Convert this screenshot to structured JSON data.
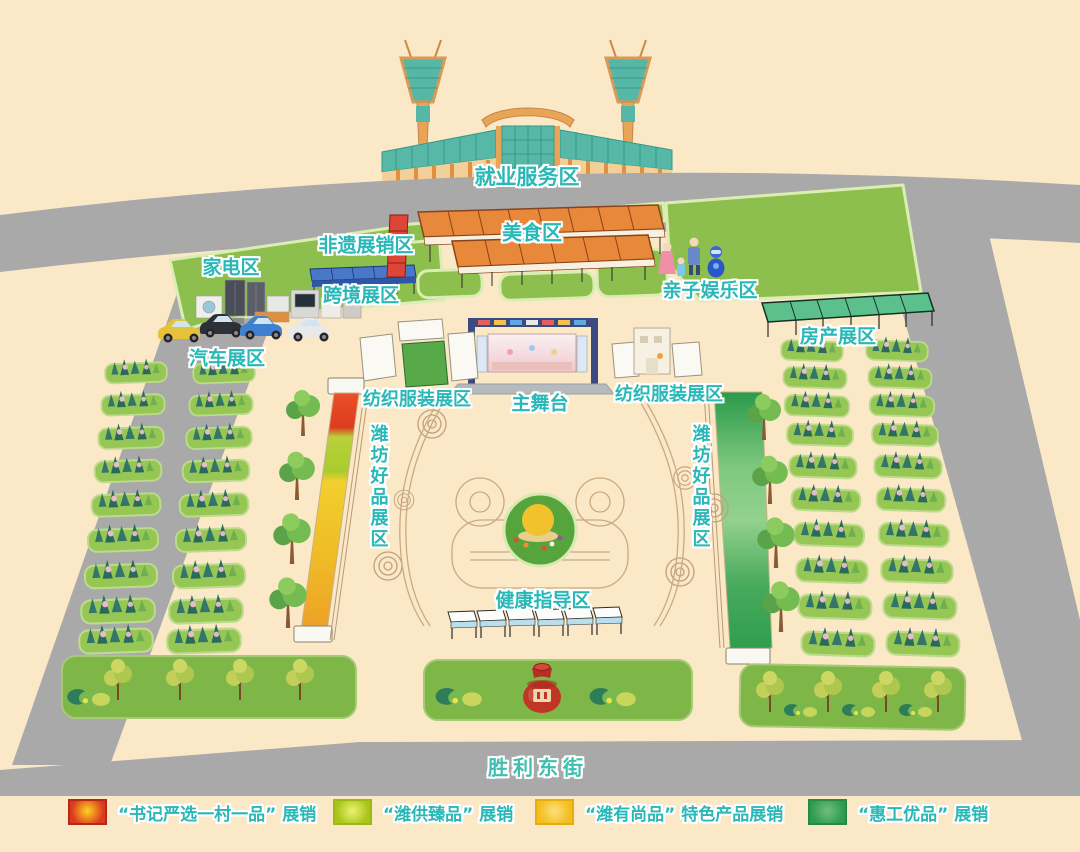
{
  "map": {
    "street": "胜利东街",
    "areas": {
      "employment": "就业服务区",
      "feiyi": "非遗展销区",
      "food": "美食区",
      "appliance": "家电区",
      "crossborder": "跨境展区",
      "family": "亲子娱乐区",
      "auto": "汽车展区",
      "realestate": "房产展区",
      "textile_left": "纺织服装展区",
      "main_stage": "主舞台",
      "textile_right": "纺织服装展区",
      "weifang_left": "潍坊好品展区",
      "weifang_right": "潍坊好品展区",
      "health": "健康指导区"
    }
  },
  "legend": {
    "items": [
      {
        "label": "“书记严选一村一品” 展销",
        "color": "#d93a20",
        "color_center": "#ffd320",
        "border": "#b22a14"
      },
      {
        "label": "“潍供臻品” 展销",
        "color": "#a7c51b",
        "color_center": "#eef26e",
        "border": "#9cb816"
      },
      {
        "label": "“潍有尚品” 特色产品展销",
        "color": "#f3bd1e",
        "color_center": "#fbe17c",
        "border": "#e4ad12"
      },
      {
        "label": "“惠工优品” 展销",
        "color": "#2e9d4f",
        "color_center": "#74bd7e",
        "border": "#278944"
      }
    ]
  }
}
